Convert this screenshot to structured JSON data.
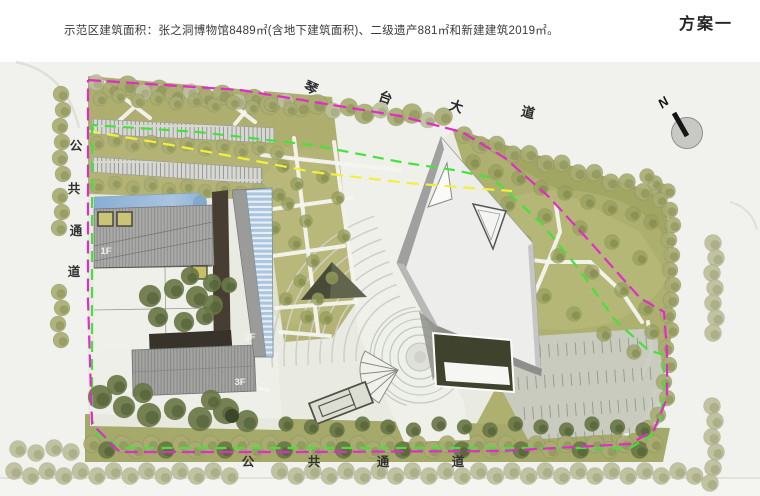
{
  "header": {
    "description": "示范区建筑面积：张之洞博物馆8489㎡(含地下建筑面积)、二级遗产881㎡和新建建筑2019㎡。",
    "plan_label": "方案一"
  },
  "plan": {
    "labels": {
      "north": "N",
      "road_top": "琴台大道",
      "passage_left": "公共通道",
      "passage_bottom": "公共通道",
      "floor_left_wing": "1F",
      "floor_tower": "3F",
      "floor_south_wing": "3F"
    },
    "colors": {
      "boundary_line": "#e52acb",
      "green_line": "#46e23c",
      "yellow_line": "#f2ef3d",
      "water": "#8fb2d6",
      "site_green": "#b2b374",
      "tree_green": "#8b9058",
      "glass_blue": "#a9c6de",
      "roof_gray": "#a9a9a7",
      "dark_building": "#3f422c"
    }
  }
}
